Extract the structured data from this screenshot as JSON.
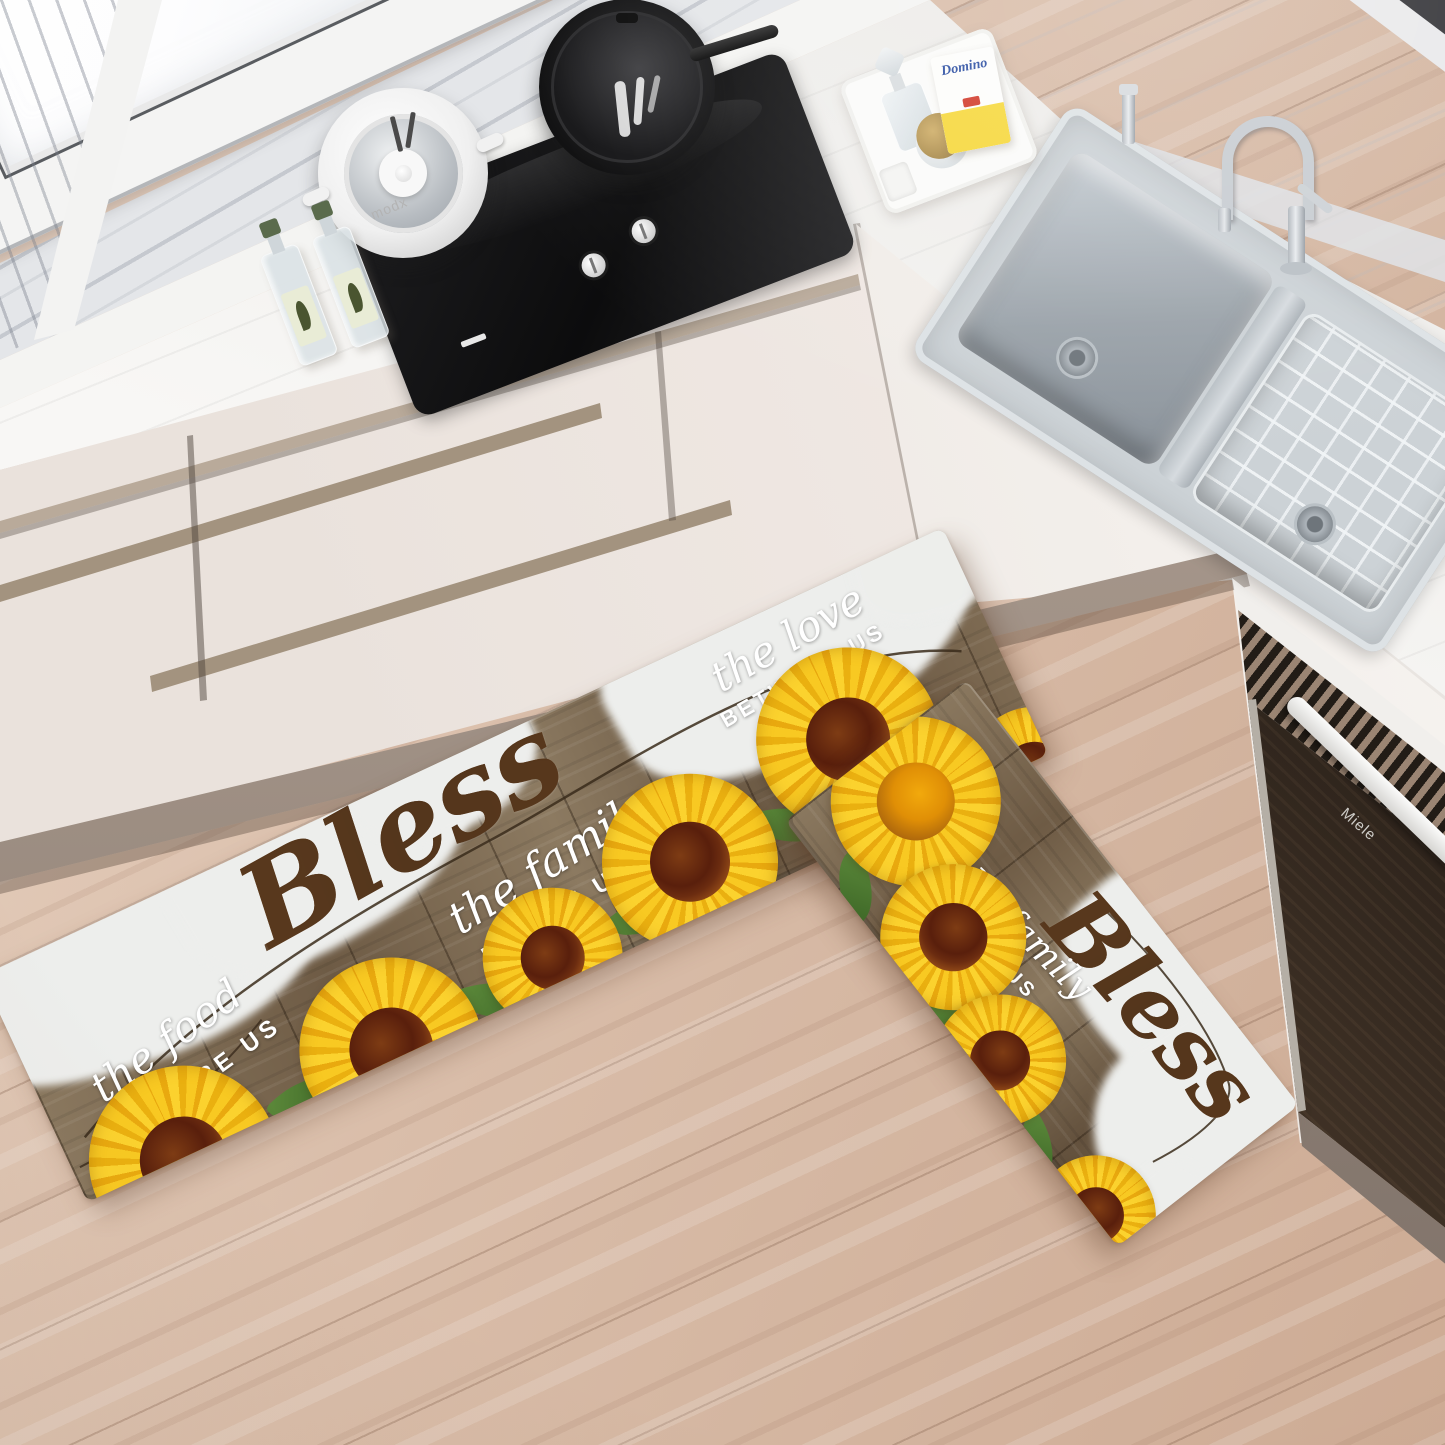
{
  "scene": {
    "description": "kitchen product photo of sunflower kitchen mat set",
    "mats": {
      "large": {
        "script_word": "Bless",
        "phrase1_script": "the food",
        "phrase1_caps": "BEFORE US",
        "phrase2_script": "the family",
        "phrase2_caps": "BESIDE US",
        "phrase3_script": "the love",
        "phrase3_caps": "BETWEEN US"
      },
      "small": {
        "script_word": "Bless",
        "phrase_script": "the family",
        "phrase_caps": "BESIDE US"
      }
    },
    "appliances": {
      "oven_brand": "Miele",
      "stockpot_brand": "modx"
    },
    "countertop_items": {
      "sugar_box_brand": "Domino"
    },
    "colors": {
      "sunflower_yellow": "#f6c51d",
      "sunflower_center_brown": "#5c2710",
      "mat_wood_brown": "#7b6850",
      "mat_paint_white": "#edeeec",
      "bless_text_brown": "#53341a",
      "floor_wood": "#d9bda9",
      "cabinet_cream": "#f1eae6",
      "counter_marble": "#f8f7f5",
      "oven_wood_dark": "#3a2d24",
      "stainless_steel": "#c9ced3",
      "domino_yellow": "#f6d83c",
      "domino_blue": "#2b4ea2",
      "bottle_cap_green": "#5a6b4c"
    }
  }
}
